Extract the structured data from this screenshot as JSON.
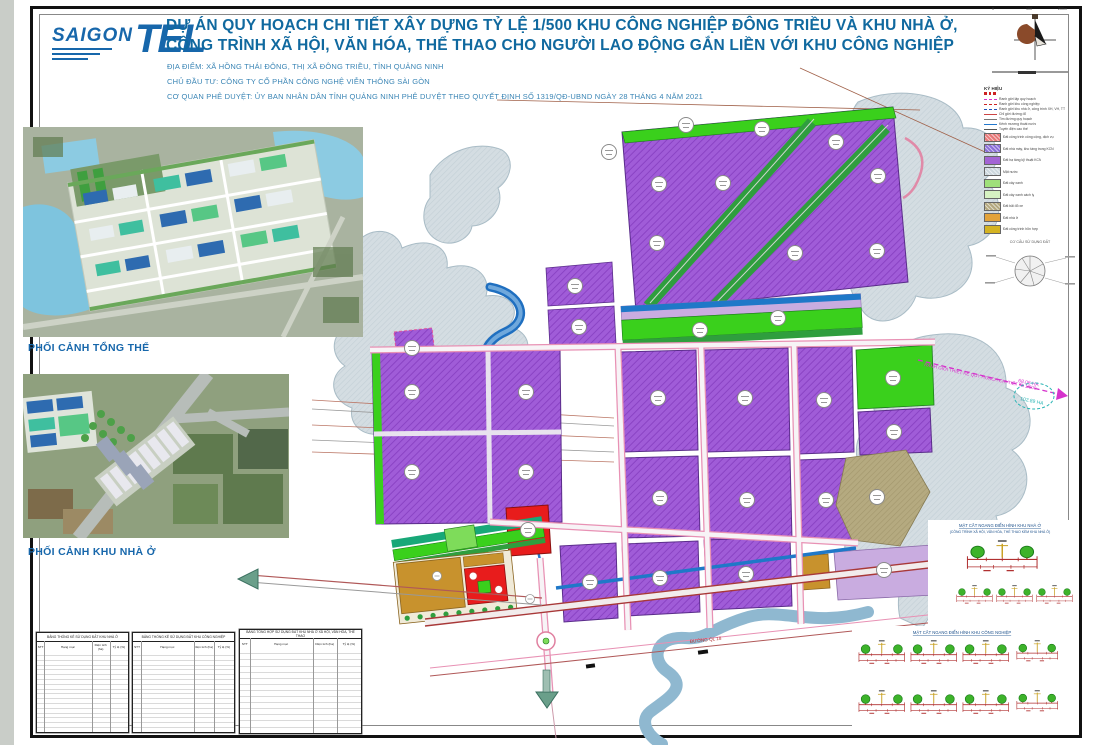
{
  "header": {
    "logo_saigon": "SAIGON",
    "logo_tel": "TEL",
    "title_line1": "DỰ ÁN QUY HOẠCH CHI TIẾT XÂY DỰNG TỶ LỆ 1/500 KHU CÔNG NGHIỆP ĐÔNG TRIỀU VÀ KHU NHÀ Ở,",
    "title_line2": "CÔNG TRÌNH XÃ HỘI, VĂN HÓA, THỂ THAO CHO NGƯỜI LAO ĐỘNG GẮN LIỀN VỚI KHU CÔNG NGHIỆP",
    "location": "ĐỊA ĐIỂM: XÃ HỒNG THÁI ĐÔNG, THỊ XÃ ĐÔNG TRIỀU, TỈNH QUẢNG NINH",
    "investor": "CHỦ ĐẦU TƯ: CÔNG TY CỔ PHẦN CÔNG NGHỆ VIỄN THÔNG SÀI GÒN",
    "approval": "CƠ QUAN PHÊ DUYỆT: ỦY BAN NHÂN DÂN TỈNH QUẢNG NINH PHÊ DUYỆT THEO QUYẾT ĐỊNH SỐ 1319/QĐ-UBND NGÀY 28 THÁNG 4 NĂM 2021"
  },
  "panels": {
    "perspective_overall_caption": "PHỐI CẢNH TỔNG THỂ",
    "perspective_housing_caption": "PHỐI CẢNH KHU NHÀ Ở"
  },
  "legend": {
    "title": "KÝ HIỆU",
    "line_items": [
      {
        "label": "Ranh giới lập quy hoạch",
        "color": "#d633cc"
      },
      {
        "label": "Ranh giới khu công nghiệp",
        "color": "#cc2222"
      },
      {
        "label": "Ranh giới khu nhà ở, công trình XH, VH, TT",
        "color": "#2255bb"
      },
      {
        "label": "Chỉ giới đường đỏ",
        "color": "#cc4444"
      },
      {
        "label": "Tim đường quy hoạch",
        "color": "#777777"
      },
      {
        "label": "Kênh mương thoát nước",
        "color": "#2277cc"
      },
      {
        "label": "Tuyến điện cao thế",
        "color": "#555555"
      }
    ],
    "area_items": [
      {
        "label": "Đất công trình công cộng, dịch vụ",
        "color": "#e87878"
      },
      {
        "label": "Đất nhà máy, kho tàng trong KCN",
        "color": "#8a6fd8"
      },
      {
        "label": "Đất hạ tầng kỹ thuật KCN",
        "color": "#a364d4"
      },
      {
        "label": "Mặt nước",
        "color": "#ccd7dd"
      },
      {
        "label": "Đất cây xanh",
        "color": "#9fe07a"
      },
      {
        "label": "Đất cây xanh cách ly",
        "color": "#d6f2c2"
      },
      {
        "label": "Đất bãi đỗ xe",
        "color": "#b3a87e"
      },
      {
        "label": "Đất nhà ở",
        "color": "#e2a23a"
      },
      {
        "label": "Đất công trình hỗn hợp",
        "color": "#d4b322"
      }
    ],
    "pie_title": "CƠ CẤU SỬ DỤNG ĐẤT",
    "scale_zero": "0",
    "scale_mid": "100",
    "scale_end": "200m"
  },
  "map": {
    "boundary_label": "RANH GIỚI THIẾT KẾ QUY HOẠCH CHI TIẾT TL 1/500",
    "area_label_1": "68.06 HA",
    "area_label_2": "102.89 HA",
    "road_label_1": "ĐƯỜNG QL 18",
    "road_label_2": "ĐI HẠ LONG"
  },
  "tables": {
    "cols": {
      "c1": "STT",
      "c2": "Hạng mục",
      "c3": "Diện tích (ha)",
      "c4": "Tỷ lệ (%)"
    },
    "t1_title": "BẢNG THỐNG KÊ SỬ DỤNG ĐẤT KHU NHÀ Ở",
    "t2_title": "BẢNG THỐNG KÊ SỬ DỤNG ĐẤT KHU CÔNG NGHIỆP",
    "t3_title": "BẢNG TỔNG HỢP SỬ DỤNG ĐẤT KHU NHÀ Ở XÃ HỘI, VĂN HÓA, THỂ THAO"
  },
  "sections": {
    "group1_title_line1": "MẶT CẮT NGANG ĐIỂN HÌNH KHU NHÀ Ở",
    "group1_title_line2": "(CÔNG TRÌNH XÃ HỘI, VĂN HÓA, THỂ THAO KÈM KHU NHÀ Ở)",
    "group2_title": "MẶT CẮT NGANG ĐIỂN HÌNH KHU CÔNG NGHIỆP"
  },
  "colors": {
    "title_blue": "#10699f",
    "logo_blue": "#1767ab",
    "industrial_purple": "#a05cd8",
    "green_buffer": "#3ad01c",
    "dark_green": "#2f9e3e",
    "water_gray": "#d4dde2",
    "river_blue": "#8fb8d0",
    "canal_blue": "#2277cc",
    "public_red": "#e81c1c",
    "housing_ochre": "#c8922d",
    "parking_khaki": "#b5aa80",
    "boundary_magenta": "#d633cc"
  }
}
